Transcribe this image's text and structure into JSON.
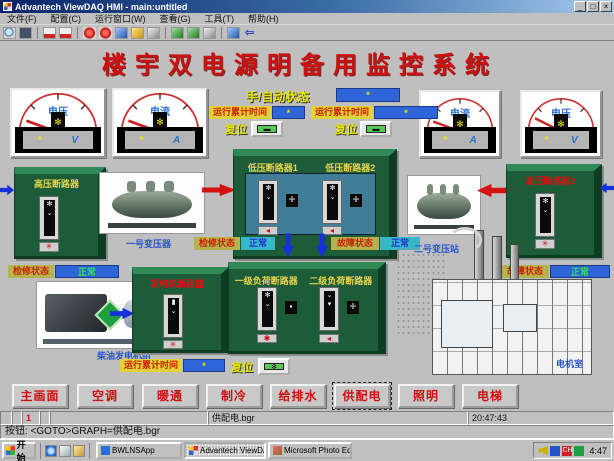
{
  "window": {
    "title": "Advantech ViewDAQ HMI - main:untitled"
  },
  "menu": {
    "items": [
      "文件(F)",
      "配置(C)",
      "运行窗口(W)",
      "查看(G)",
      "工具(T)",
      "帮助(H)"
    ]
  },
  "toolbar": {
    "icons": [
      "search",
      "monitor",
      "flow-chart",
      "trend-chart",
      "alarm-ball",
      "alarm-ball-2",
      "marker",
      "lock",
      "recorder",
      "confirm",
      "apply",
      "exchange",
      "package",
      "back"
    ]
  },
  "screen": {
    "title": "楼宇双电源明备用监控系统",
    "mode": {
      "label": "手/自动状态",
      "value": "*"
    },
    "runtime": [
      {
        "label": "运行累计时间",
        "value": "*"
      },
      {
        "label": "运行累计时间",
        "value": "*"
      },
      {
        "label": "运行累计时间",
        "value": "*"
      }
    ],
    "reset": [
      {
        "label": "复位"
      },
      {
        "label": "复位"
      },
      {
        "label": "复位"
      }
    ],
    "meters": [
      {
        "label": "电压",
        "value": "*",
        "unit": "V"
      },
      {
        "label": "电流",
        "value": "*",
        "unit": "A"
      },
      {
        "label": "电流",
        "value": "*",
        "unit": "A"
      },
      {
        "label": "电压",
        "value": "*",
        "unit": "V"
      }
    ],
    "breakers": {
      "hv1": "高压断路器",
      "hv2": "高压断路器2",
      "lv1": "低压断路器1",
      "lv2": "低压断路器2",
      "gen": "发电机断路器",
      "load1": "一级负荷断路器",
      "load2": "二级负荷断路器"
    },
    "status": {
      "left": {
        "label": "检修状态",
        "value": "正常"
      },
      "center_left": {
        "label": "检修状态",
        "value": "正常"
      },
      "center_right": {
        "label": "故障状态",
        "value": "正常"
      },
      "right": {
        "label": "故障状态",
        "value": "正常"
      }
    },
    "equipment": {
      "transformer1": "一号变压器",
      "transformer2": "二号变压站",
      "generator": "柴油发电机组",
      "building": "电机室"
    },
    "nav": {
      "items": [
        "主画面",
        "空调",
        "暖通",
        "制冷",
        "给排水",
        "供配电",
        "照明",
        "电梯"
      ],
      "active": "供配电"
    }
  },
  "statusbar": {
    "page": "1",
    "file": "供配电.bgr",
    "clock": "20:47:43",
    "message": "按钮: <GOTO>GRAPH=供配电.bgr"
  },
  "taskbar": {
    "start": "开始",
    "tasks": [
      "BWLNSApp",
      "Advantech ViewDAQ HMI",
      "Microsoft Photo Editor"
    ],
    "tray_time": "4:47"
  },
  "colors": {
    "title_red": "#cc1111",
    "box_green": "#1d5c39",
    "panel_teal": "#3f7d99",
    "value_blue": "#2e66d9",
    "label_yellow": "#e8e24a"
  }
}
